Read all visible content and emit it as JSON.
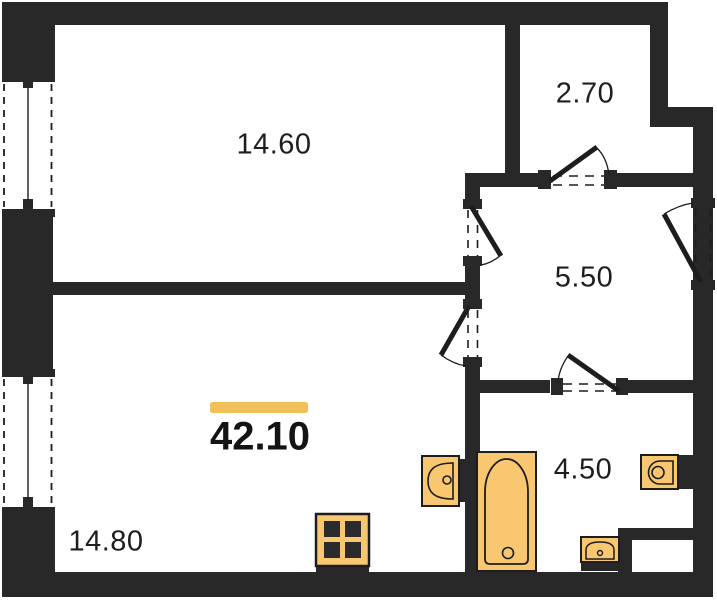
{
  "plan": {
    "type": "apartment-floor-plan",
    "labels": {
      "total_area": "42.10",
      "room_top_left": "14.60",
      "room_top_right": "2.70",
      "room_hallway": "5.50",
      "room_bathroom": "4.50",
      "room_bottom_left": "14.80"
    },
    "colors": {
      "wall": "#282828",
      "outline": "#1d1d1d",
      "fixture_fill": "#F8C76F",
      "accent_bar": "#F3BF58",
      "background": "#FFFFFF",
      "text": "#1e1e1e"
    },
    "icons": [
      "window-icon",
      "door-swing-icon",
      "kitchen-sink-icon",
      "stove-icon",
      "bathtub-icon",
      "washbasin-icon",
      "toilet-icon",
      "small-sink-icon"
    ]
  }
}
